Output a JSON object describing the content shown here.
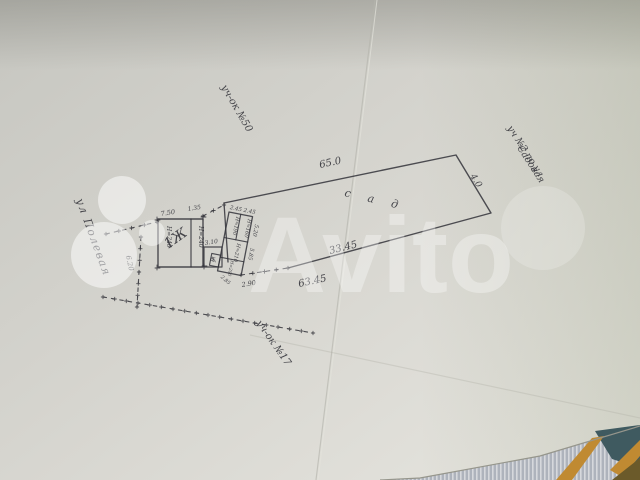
{
  "plan": {
    "street_left": "ул Полевая",
    "plot_top": "уч-ок №50",
    "neighbor_right_line1": "уч №2 по ул",
    "neighbor_right_line2": "Садовая",
    "plot_bottom": "уч-ок №17",
    "garden": "с а д",
    "dims": {
      "top": "65.0",
      "right": "4.0",
      "bottom_inner": "33.45",
      "bottom_outer": "63.45",
      "left_fence": "6.20",
      "gap": "2.90"
    },
    "house": {
      "label": "1Ж",
      "height_left": "H=240",
      "height_right": "H=240",
      "width_main": "7.50",
      "width_right": "1.35",
      "annex_width": "3.10",
      "annex_label": "в"
    },
    "sheds": {
      "top_widths": "2.45  2.45",
      "right_len_top": "5.20",
      "right_len_bottom": "5.85",
      "bottom_width": "2.85",
      "cell1": "H=190",
      "cell2": "H=160",
      "cell3": "H=210",
      "cell4": "H=200",
      "outhouse": "уб"
    }
  },
  "watermark": {
    "brand": "Avito"
  },
  "colors": {
    "ink": "#33333a",
    "paper": "#d3d2cc",
    "watermark": "#ffffff"
  }
}
